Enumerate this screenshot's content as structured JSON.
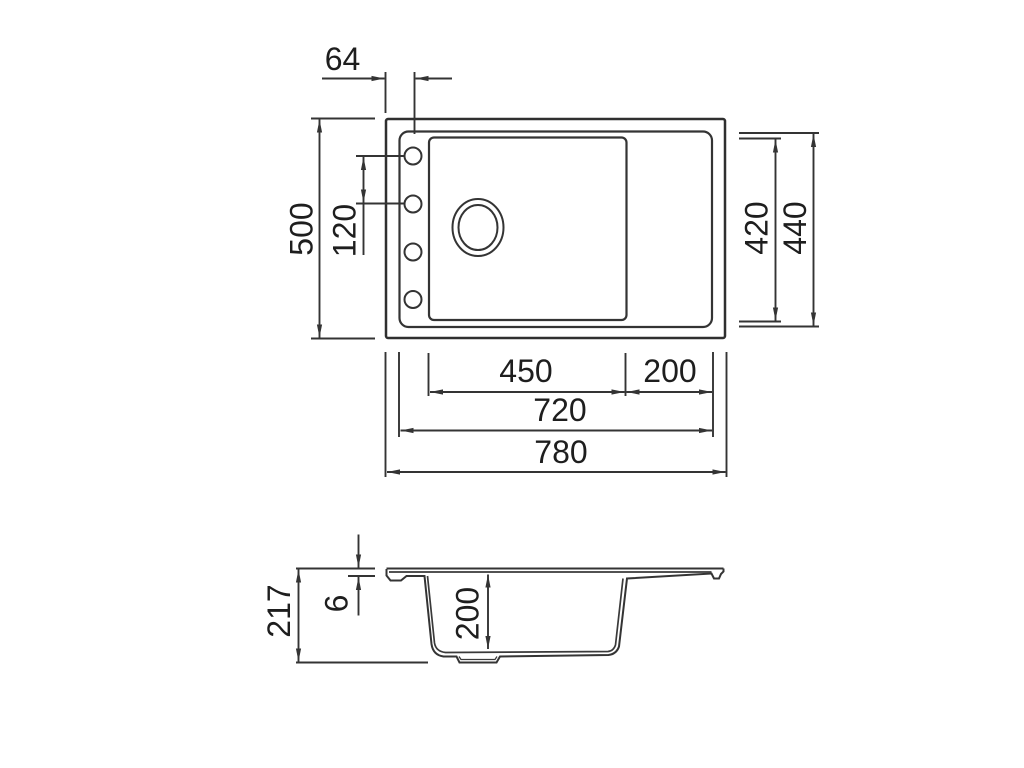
{
  "drawing": {
    "kind": "sink-technical-drawing",
    "units_note": "",
    "plan_view": {
      "dim_hole_offset": "64",
      "dim_outer_depth": "500",
      "dim_hole_pitch": "120",
      "dim_bowl_inner_depth": "420",
      "dim_rim_inner_depth": "440",
      "dim_bowl_width": "450",
      "dim_drainer_width": "200",
      "dim_rim_inner_width": "720",
      "dim_outer_width": "780"
    },
    "section_view": {
      "dim_total_height": "217",
      "dim_rim_thickness": "6",
      "dim_bowl_depth": "200"
    },
    "colors": {
      "line": "#343434",
      "text": "#1e1e1e",
      "background": "#ffffff"
    }
  }
}
